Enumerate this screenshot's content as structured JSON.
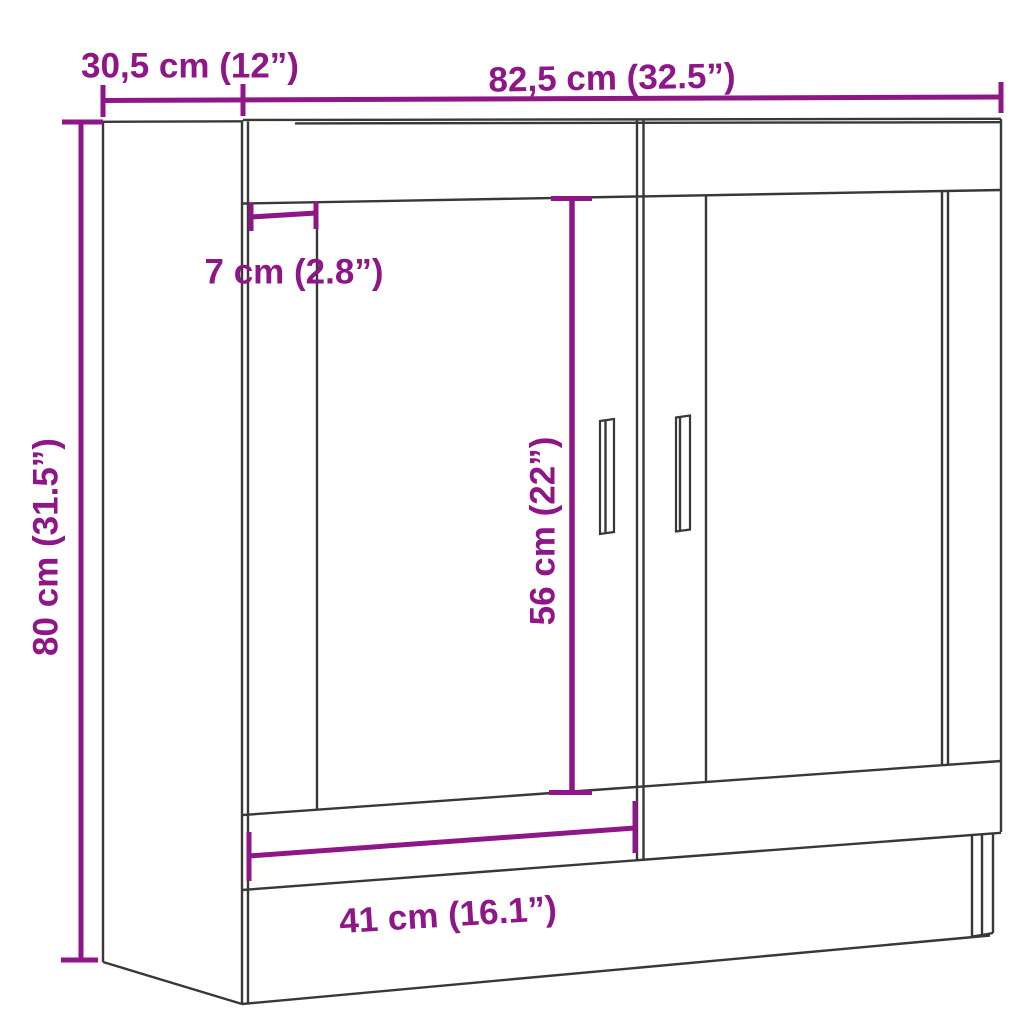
{
  "accent_color": "#8e1687",
  "line_color": "#383838",
  "background_color": "#ffffff",
  "dimensions": {
    "depth": {
      "label": "30,5 cm (12”)",
      "cm": "30,5",
      "inches": "12"
    },
    "width": {
      "label": "82,5 cm (32.5”)",
      "cm": "82,5",
      "inches": "32.5"
    },
    "frame": {
      "label": "7 cm (2.8”)",
      "cm": "7",
      "inches": "2.8"
    },
    "handle": {
      "label": "56 cm (22”)",
      "cm": "56",
      "inches": "22"
    },
    "height": {
      "label": "80 cm (31.5”)",
      "cm": "80",
      "inches": "31.5"
    },
    "door": {
      "label": "41 cm (16.1”)",
      "cm": "41",
      "inches": "16.1"
    }
  }
}
